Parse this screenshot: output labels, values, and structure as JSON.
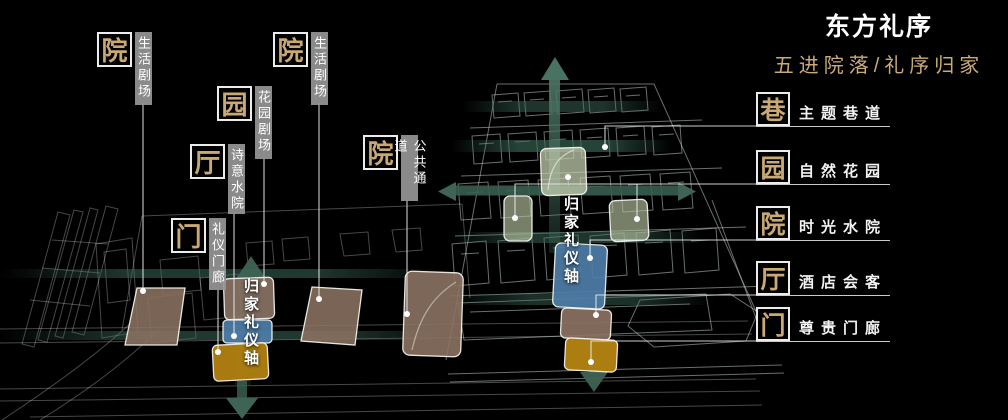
{
  "header": {
    "title": "东方礼序",
    "subtitle": "五进院落/礼序归家"
  },
  "left_plan": {
    "axis_label": "归家礼仪轴",
    "callouts": [
      {
        "char": "院",
        "label": "生活剧场"
      },
      {
        "char": "园",
        "label": "花园剧场"
      },
      {
        "char": "厅",
        "label": "诗意水院"
      },
      {
        "char": "院",
        "label": "生活剧场"
      },
      {
        "char": "院",
        "label": "公共通道"
      },
      {
        "char": "门",
        "label": "礼仪门廊"
      }
    ]
  },
  "right_plan": {
    "axis_label": "归家礼仪轴"
  },
  "legend": {
    "items": [
      {
        "char": "巷",
        "label": "主题巷道"
      },
      {
        "char": "园",
        "label": "自然花园"
      },
      {
        "char": "院",
        "label": "时光水院"
      },
      {
        "char": "厅",
        "label": "酒店会客"
      },
      {
        "char": "门",
        "label": "尊贵门廊"
      }
    ]
  },
  "colors": {
    "background": "#000000",
    "accent_tan": "#c9a873",
    "label_bar_gray": "#969696",
    "axis_teal": "#3f6355",
    "patch_brown": "#8b7262",
    "patch_blue": "#4e7ea9",
    "patch_gold": "#b28111",
    "patch_sage": "#bfcaa8"
  }
}
